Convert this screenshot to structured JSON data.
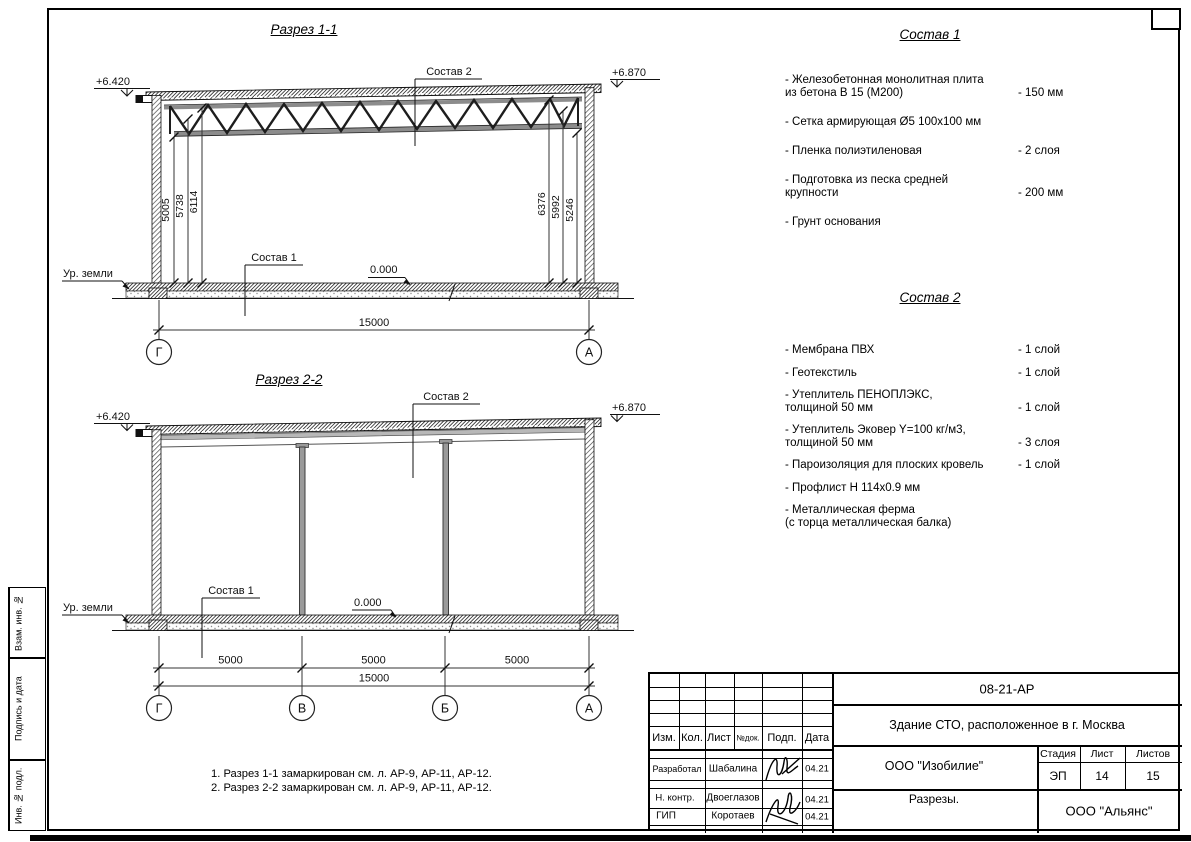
{
  "sections": {
    "s1": {
      "title": "Разрез 1-1",
      "elev_left": "+6.420",
      "elev_right": "+6.870",
      "label_sostav2": "Состав 2",
      "label_sostav1": "Состав 1",
      "zero_mark": "0.000",
      "ground_label": "Ур. земли",
      "dims_left": [
        "5005",
        "5738",
        "6114"
      ],
      "dims_right": [
        "6376",
        "5992",
        "5246"
      ],
      "dim_total": "15000",
      "grid_left": "Г",
      "grid_right": "А"
    },
    "s2": {
      "title": "Разрез 2-2",
      "elev_left": "+6.420",
      "elev_right": "+6.870",
      "label_sostav2": "Состав 2",
      "label_sostav1": "Состав 1",
      "zero_mark": "0.000",
      "ground_label": "Ур. земли",
      "dims_span": [
        "5000",
        "5000",
        "5000"
      ],
      "dim_total": "15000",
      "grids": [
        "Г",
        "В",
        "Б",
        "А"
      ]
    }
  },
  "materials": {
    "c1": {
      "title": "Состав 1",
      "items": [
        {
          "name": "- Железобетонная  монолитная плита\nиз бетона В 15 (М200)",
          "value": "- 150 мм"
        },
        {
          "name": "- Сетка армирующая Ø5 100x100 мм",
          "value": ""
        },
        {
          "name": "- Пленка полиэтиленовая",
          "value": "-  2 слоя"
        },
        {
          "name": "- Подготовка из песка средней\nкрупности",
          "value": "- 200 мм"
        },
        {
          "name": "- Грунт основания",
          "value": ""
        }
      ]
    },
    "c2": {
      "title": "Состав 2",
      "items": [
        {
          "name": "- Мембрана ПВХ",
          "value": "- 1 слой"
        },
        {
          "name": "- Геотекстиль",
          "value": "- 1 слой"
        },
        {
          "name": "- Утеплитель ПЕНОПЛЭКС,\nтолщиной 50 мм",
          "value": "- 1 слой"
        },
        {
          "name": "- Утеплитель Эковер Y=100 кг/м3,\nтолщиной 50 мм",
          "value": "- 3 слоя"
        },
        {
          "name": "- Пароизоляция для плоских кровель",
          "value": "- 1 слой"
        },
        {
          "name": "- Профлист Н 114x0.9 мм",
          "value": ""
        },
        {
          "name": "- Металлическая ферма\n(с торца металлическая балка)",
          "value": ""
        }
      ]
    }
  },
  "notes": [
    "1. Разрез 1-1 замаркирован см. л. АР-9, АР-11, АР-12.",
    "2. Разрез 2-2 замаркирован см. л. АР-9, АР-11, АР-12."
  ],
  "titleblock": {
    "code": "08-21-АР",
    "project": "Здание СТО, расположенное в г. Москва",
    "org": "ООО \"Изобилие\"",
    "sheet_name": "Разрезы.",
    "company": "ООО \"Альянс\"",
    "stage_label": "Стадия",
    "sheet_label": "Лист",
    "sheets_label": "Листов",
    "stage": "ЭП",
    "sheet": "14",
    "sheets": "15",
    "cols": {
      "izm": "Изм.",
      "kol": "Кол.",
      "list": "Лист",
      "ndok": "№док.",
      "podp": "Подп.",
      "data": "Дата"
    },
    "rows": [
      {
        "role": "Разработал",
        "name": "Шабалина",
        "date": "04.21"
      },
      {
        "role": "Н. контр.",
        "name": "Двоеглазов",
        "date": "04.21"
      },
      {
        "role": "ГИП",
        "name": "Коротаев",
        "date": "04.21"
      }
    ]
  },
  "stamps": [
    "Взам. инв. №",
    "Подпись и дата",
    "Инв. № подл."
  ]
}
